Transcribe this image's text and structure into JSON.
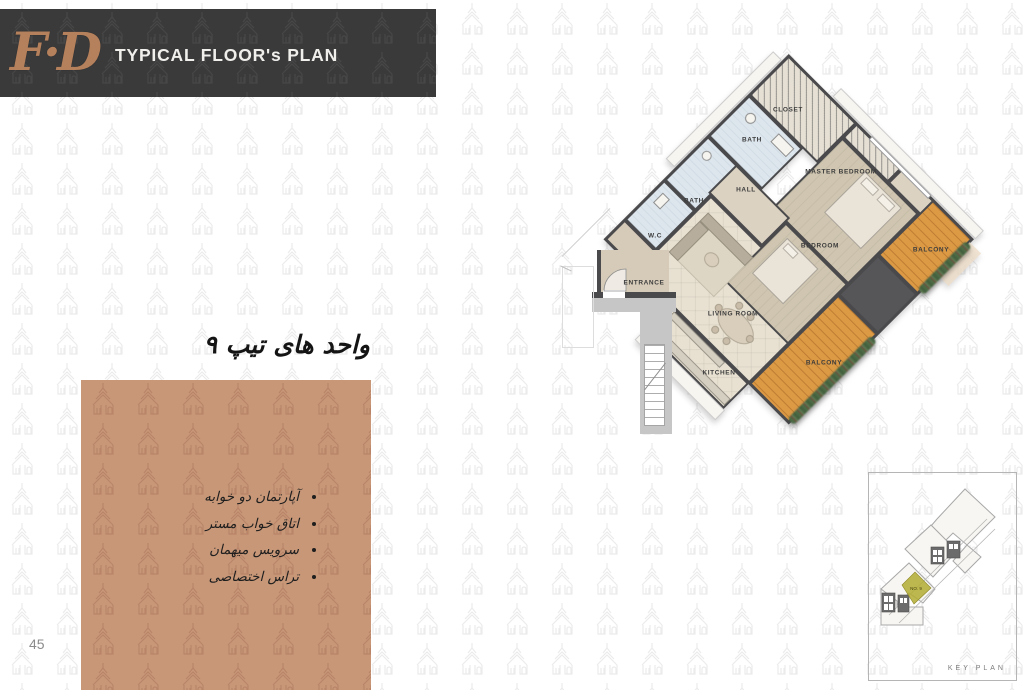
{
  "page": {
    "number": "45",
    "background": "#ffffff"
  },
  "header": {
    "title": "TYPICAL FLOOR's PLAN",
    "logo": "F·D",
    "bar_color": "#3a3a3b",
    "logo_color": "#b5815c"
  },
  "unit_title": {
    "text": "واحد های تیپ ۹"
  },
  "info_block": {
    "color": "#c79778",
    "items": [
      "آپارتمان دو خوابه",
      "اتاق خواب مستر",
      "سرویس میهمان",
      "تراس اختصاصی"
    ]
  },
  "floor_plan": {
    "wall_color": "#4a4a4c",
    "balcony_color": "#dc9a45",
    "bath_color": "#dde6ed",
    "bedroom_color": "#cfc5b0",
    "living_color": "#e8e1d2",
    "labels": [
      {
        "label": "CLOSET",
        "x": 788,
        "y": 110
      },
      {
        "label": "BATH",
        "x": 752,
        "y": 140
      },
      {
        "label": "MASTER BEDROOM",
        "x": 841,
        "y": 172
      },
      {
        "label": "HALL",
        "x": 746,
        "y": 190
      },
      {
        "label": "BATH",
        "x": 694,
        "y": 201
      },
      {
        "label": "W.C",
        "x": 655,
        "y": 236
      },
      {
        "label": "BEDROOM",
        "x": 820,
        "y": 246
      },
      {
        "label": "BALCONY",
        "x": 931,
        "y": 250
      },
      {
        "label": "ENTRANCE",
        "x": 644,
        "y": 283
      },
      {
        "label": "LIVING ROOM",
        "x": 733,
        "y": 314
      },
      {
        "label": "BALCONY",
        "x": 824,
        "y": 363
      },
      {
        "label": "KITCHEN",
        "x": 719,
        "y": 373
      }
    ]
  },
  "key_plan": {
    "label": "KEY PLAN",
    "unit_label": "NO. 9",
    "highlight_color": "#b3ac33"
  },
  "watermark": {
    "light": "#ebebeb",
    "on_header": "#474747",
    "on_block": "#b98468"
  }
}
